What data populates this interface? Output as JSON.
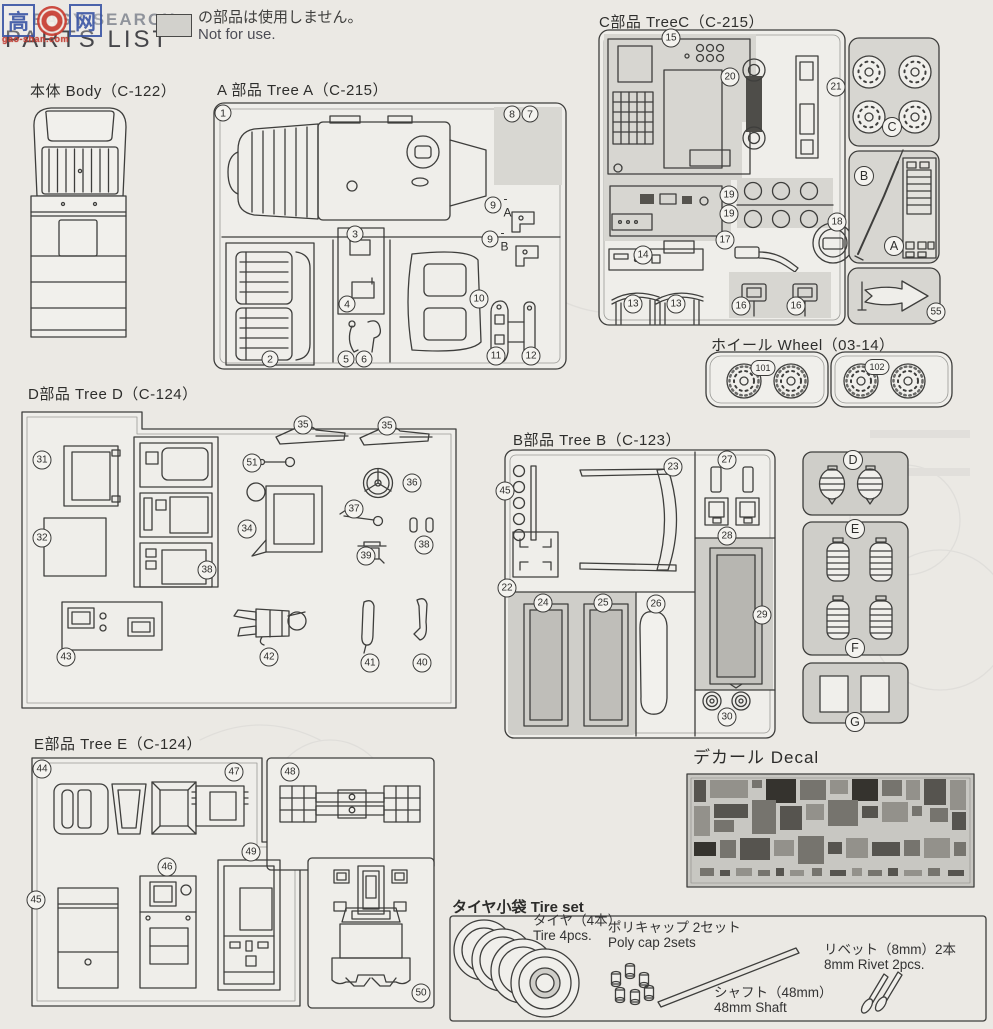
{
  "header": {
    "watermark": {
      "left_char": "高",
      "right_char": "网",
      "subtext": "gao-shan.com"
    },
    "search_label": "EASY SEARCH",
    "title": "PARTS LIST",
    "not_for_use": {
      "jp": "の部品は使用しません。",
      "en": "Not for use."
    }
  },
  "sections": {
    "body": {
      "title": "本体 Body（C-122）"
    },
    "tree_a": {
      "title": "A 部品 Tree A（C-215）",
      "badges": [
        {
          "n": "1",
          "x": 223,
          "y": 113
        },
        {
          "n": "8",
          "x": 512,
          "y": 114
        },
        {
          "n": "7",
          "x": 530,
          "y": 114
        },
        {
          "n": "9",
          "suffix": "- A",
          "x": 493,
          "y": 205
        },
        {
          "n": "9",
          "suffix": "- B",
          "x": 490,
          "y": 239
        },
        {
          "n": "3",
          "x": 355,
          "y": 234
        },
        {
          "n": "4",
          "x": 347,
          "y": 304
        },
        {
          "n": "2",
          "x": 270,
          "y": 359
        },
        {
          "n": "5",
          "x": 346,
          "y": 359
        },
        {
          "n": "6",
          "x": 364,
          "y": 359
        },
        {
          "n": "10",
          "x": 479,
          "y": 299
        },
        {
          "n": "11",
          "x": 496,
          "y": 356
        },
        {
          "n": "12",
          "x": 531,
          "y": 356
        }
      ]
    },
    "tree_c": {
      "title": "C部品 TreeC（C-215）",
      "badges": [
        {
          "n": "15",
          "x": 671,
          "y": 38
        },
        {
          "n": "20",
          "x": 730,
          "y": 77
        },
        {
          "n": "21",
          "x": 836,
          "y": 87
        },
        {
          "n": "19",
          "x": 729,
          "y": 195
        },
        {
          "n": "19",
          "x": 729,
          "y": 214
        },
        {
          "n": "17",
          "x": 725,
          "y": 240
        },
        {
          "n": "18",
          "x": 837,
          "y": 222
        },
        {
          "n": "14",
          "x": 643,
          "y": 255
        },
        {
          "n": "13",
          "x": 633,
          "y": 304
        },
        {
          "n": "13",
          "x": 676,
          "y": 304
        },
        {
          "n": "16",
          "x": 741,
          "y": 306
        },
        {
          "n": "16",
          "x": 796,
          "y": 306
        },
        {
          "n": "55",
          "x": 936,
          "y": 312
        },
        {
          "n": "C",
          "x": 892,
          "y": 127
        },
        {
          "n": "B",
          "x": 864,
          "y": 176
        },
        {
          "n": "A",
          "x": 894,
          "y": 246
        }
      ]
    },
    "wheel": {
      "title": "ホイール Wheel（03-14）",
      "badges": [
        {
          "n": "101",
          "x": 763,
          "y": 368
        },
        {
          "n": "102",
          "x": 877,
          "y": 367
        }
      ]
    },
    "tree_d": {
      "title": "D部品 Tree D（C-124）",
      "badges": [
        {
          "n": "31",
          "x": 42,
          "y": 460
        },
        {
          "n": "32",
          "x": 42,
          "y": 538
        },
        {
          "n": "35",
          "x": 303,
          "y": 425
        },
        {
          "n": "35",
          "x": 387,
          "y": 426
        },
        {
          "n": "51",
          "x": 252,
          "y": 463
        },
        {
          "n": "34",
          "x": 247,
          "y": 529
        },
        {
          "n": "36",
          "x": 412,
          "y": 483
        },
        {
          "n": "37",
          "x": 354,
          "y": 509
        },
        {
          "n": "38",
          "x": 424,
          "y": 545
        },
        {
          "n": "39",
          "x": 366,
          "y": 556
        },
        {
          "n": "38",
          "x": 207,
          "y": 570
        },
        {
          "n": "43",
          "x": 66,
          "y": 657
        },
        {
          "n": "42",
          "x": 269,
          "y": 657
        },
        {
          "n": "41",
          "x": 370,
          "y": 663
        },
        {
          "n": "40",
          "x": 422,
          "y": 663
        }
      ]
    },
    "tree_b": {
      "title": "B部品 Tree B（C-123）",
      "badges": [
        {
          "n": "45",
          "x": 505,
          "y": 491
        },
        {
          "n": "23",
          "x": 673,
          "y": 467
        },
        {
          "n": "27",
          "x": 727,
          "y": 460
        },
        {
          "n": "28",
          "x": 727,
          "y": 536
        },
        {
          "n": "22",
          "x": 507,
          "y": 588
        },
        {
          "n": "24",
          "x": 543,
          "y": 603
        },
        {
          "n": "25",
          "x": 603,
          "y": 603
        },
        {
          "n": "26",
          "x": 656,
          "y": 604
        },
        {
          "n": "29",
          "x": 762,
          "y": 615
        },
        {
          "n": "30",
          "x": 727,
          "y": 717
        },
        {
          "n": "D",
          "x": 853,
          "y": 460
        },
        {
          "n": "E",
          "x": 855,
          "y": 529
        },
        {
          "n": "F",
          "x": 855,
          "y": 648
        },
        {
          "n": "G",
          "x": 855,
          "y": 722
        }
      ]
    },
    "tree_e": {
      "title": "E部品 Tree E（C-124）",
      "badges": [
        {
          "n": "44",
          "x": 42,
          "y": 769
        },
        {
          "n": "47",
          "x": 234,
          "y": 772
        },
        {
          "n": "48",
          "x": 290,
          "y": 772
        },
        {
          "n": "46",
          "x": 167,
          "y": 867
        },
        {
          "n": "49",
          "x": 251,
          "y": 852
        },
        {
          "n": "45",
          "x": 36,
          "y": 900
        },
        {
          "n": "50",
          "x": 421,
          "y": 993
        }
      ]
    },
    "decal": {
      "title": "デカール Decal"
    },
    "tire_set": {
      "title": "タイヤ小袋 Tire set",
      "items": [
        {
          "jp": "タイヤ（4本）",
          "en": "Tire 4pcs.",
          "x": 533,
          "y": 913
        },
        {
          "jp": "ポリキャップ 2セット",
          "en": "Poly cap 2sets",
          "x": 608,
          "y": 920
        },
        {
          "jp": "リベット（8mm）2本",
          "en": "8mm Rivet 2pcs.",
          "x": 824,
          "y": 942
        },
        {
          "jp": "シャフト（48mm）",
          "en": "48mm Shaft",
          "x": 714,
          "y": 985
        }
      ]
    }
  }
}
